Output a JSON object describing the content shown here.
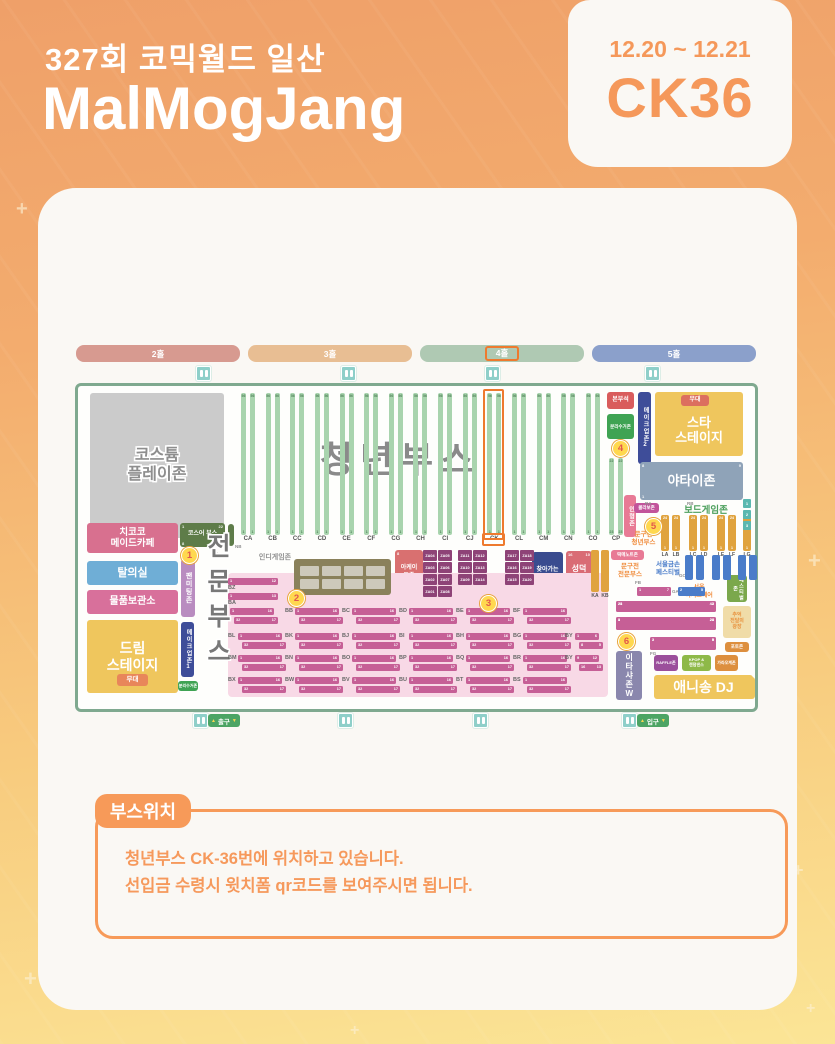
{
  "header": {
    "event": "327회 코믹월드 일산",
    "title": "MalMogJang",
    "date_range": "12.20 ~ 12.21",
    "booth_code": "CK36"
  },
  "location_note": {
    "badge": "부스위치",
    "line1": "청년부스 CK-36번에 위치하고 있습니다.",
    "line2": "선입금 수령시 윗치폼 qr코드를 보여주시면 됩니다."
  },
  "decor": {
    "plus_marks": [
      {
        "x": 16,
        "y": 198,
        "s": 20
      },
      {
        "x": 808,
        "y": 548,
        "s": 22
      },
      {
        "x": 793,
        "y": 860,
        "s": 18
      },
      {
        "x": 24,
        "y": 966,
        "s": 22
      },
      {
        "x": 350,
        "y": 1022,
        "s": 16
      },
      {
        "x": 806,
        "y": 1000,
        "s": 16
      }
    ]
  },
  "map": {
    "halls": [
      {
        "label": "2홀",
        "x": 1,
        "w": 164,
        "color": "#D79A90",
        "highlighted": false
      },
      {
        "label": "3홀",
        "x": 173,
        "w": 164,
        "color": "#E8BE93",
        "highlighted": false
      },
      {
        "label": "4홀",
        "x": 345,
        "w": 164,
        "color": "#AFC9B3",
        "highlighted": true
      },
      {
        "label": "5홀",
        "x": 517,
        "w": 164,
        "color": "#8BA0CB",
        "highlighted": false
      }
    ],
    "restrooms": {
      "top": [
        121,
        266,
        410,
        570
      ],
      "bottom": [
        118,
        263,
        398,
        547
      ]
    },
    "signs": [
      {
        "name": "exit-sign",
        "label": "출구",
        "x": 133
      },
      {
        "name": "entry-sign",
        "label": "입구",
        "x": 562
      }
    ],
    "youth": {
      "big_label": "청년부스",
      "columns": [
        "CA",
        "CB",
        "CC",
        "CD",
        "CE",
        "CF",
        "CG",
        "CH",
        "CI",
        "CJ",
        "CK",
        "CL",
        "CM",
        "CN",
        "CO"
      ],
      "highlight": "CK",
      "first_x": 166,
      "dx": 24.64,
      "y": 48,
      "h": 142,
      "label_y": 191,
      "top_num": "56",
      "bottom_num": "1",
      "cp": {
        "label": "CP",
        "x": 534,
        "y": 113,
        "h": 77,
        "nums": [
          "22",
          "23"
        ]
      }
    },
    "zones": [
      {
        "n": "costume-playzone",
        "x": 15,
        "y": 48,
        "w": 134,
        "h": 145,
        "bg": "#CBCBCB",
        "fg": "#8E8E8E",
        "fs": 16,
        "fw": 800,
        "out": true,
        "lines": [
          "코스튬",
          "플레이존"
        ]
      },
      {
        "n": "chikoko-maid-cafe",
        "x": 12,
        "y": 178,
        "w": 91,
        "h": 30,
        "bg": "#D8708F",
        "fs": 9.5,
        "lines": [
          "치코코",
          "메이드카페"
        ]
      },
      {
        "n": "cosplayer-booth",
        "x": 105,
        "y": 178,
        "w": 45,
        "h": 24,
        "bg": "#5E7C49",
        "fs": 6,
        "lines": [
          "코스어 부스"
        ],
        "corners": [
          "1",
          "22",
          "8",
          "28"
        ]
      },
      {
        "n": "cosplayer-side-column",
        "x": 153,
        "y": 179,
        "w": 6,
        "h": 22,
        "bg": "#5E7C49",
        "fs": 4,
        "lines": []
      },
      {
        "n": "fitting-room",
        "x": 12,
        "y": 216,
        "w": 91,
        "h": 24,
        "bg": "#6FAED6",
        "fs": 11,
        "lines": [
          "탈의실"
        ]
      },
      {
        "n": "fan-meeting-zone",
        "x": 106,
        "y": 214,
        "w": 14,
        "h": 58,
        "bg": "#B98CC0",
        "fs": 7,
        "v": true,
        "lines": [
          "팬미팅존"
        ]
      },
      {
        "n": "storage",
        "x": 12,
        "y": 245,
        "w": 91,
        "h": 24,
        "bg": "#D8709B",
        "fs": 10,
        "lines": [
          "물품보관소"
        ]
      },
      {
        "n": "dream-stage",
        "x": 12,
        "y": 275,
        "w": 91,
        "h": 73,
        "bg": "#EFC65D",
        "fs": 14,
        "fw": 800,
        "lines": [
          "드림",
          "스테이지"
        ]
      },
      {
        "n": "dream-stage-stand",
        "x": 42,
        "y": 329,
        "w": 31,
        "h": 12,
        "bg": "#E8865A",
        "fs": 6.5,
        "lines": [
          "무대"
        ]
      },
      {
        "n": "makeup-zone-1",
        "x": 106,
        "y": 277,
        "w": 13,
        "h": 55,
        "bg": "#3E4D99",
        "fs": 6,
        "v": true,
        "lines": [
          "메이크업존1"
        ]
      },
      {
        "n": "recycle-zone-left",
        "x": 103,
        "y": 336,
        "w": 20,
        "h": 10,
        "bg": "#3FA353",
        "fs": 4,
        "lines": [
          "분리수거존"
        ]
      },
      {
        "n": "hq-seat",
        "x": 532,
        "y": 47,
        "w": 27,
        "h": 17,
        "bg": "#D95C5C",
        "fs": 6,
        "lines": [
          "본부석"
        ]
      },
      {
        "n": "recycle-zone-top",
        "x": 532,
        "y": 69,
        "w": 27,
        "h": 25,
        "bg": "#3FA353",
        "fs": 4.5,
        "lines": [
          "분리수거존"
        ]
      },
      {
        "n": "makeup-zone-2",
        "x": 563,
        "y": 47,
        "w": 13,
        "h": 72,
        "bg": "#3E4D99",
        "fs": 6,
        "v": true,
        "lines": [
          "메이크업존2"
        ]
      },
      {
        "n": "star-stage",
        "x": 580,
        "y": 47,
        "w": 88,
        "h": 64,
        "bg": "#EFC65D",
        "fs": 13,
        "fw": 800,
        "pt": 12,
        "lines": [
          "스타",
          "스테이지"
        ]
      },
      {
        "n": "star-stage-stand",
        "x": 606,
        "y": 50,
        "w": 28,
        "h": 11,
        "bg": "#DC6F5F",
        "fs": 6,
        "lines": [
          "무대"
        ]
      },
      {
        "n": "yatai-zone",
        "x": 565,
        "y": 117,
        "w": 103,
        "h": 38,
        "bg": "#8FA3B8",
        "fs": 13,
        "fw": 800,
        "lines": [
          "야타이존"
        ],
        "corners": [
          "8",
          "9",
          "1",
          ""
        ]
      },
      {
        "n": "doll-zone",
        "x": 549,
        "y": 150,
        "w": 12,
        "h": 42,
        "bg": "#E87A95",
        "fs": 6,
        "v": true,
        "lines": [
          "인형존"
        ]
      },
      {
        "n": "collab-zone",
        "x": 559,
        "y": 158,
        "w": 25,
        "h": 10,
        "bg": "#C2549B",
        "fs": 4.5,
        "lines": [
          "콜라보존"
        ]
      },
      {
        "n": "ddeokme-note-zone",
        "x": 536,
        "y": 205,
        "w": 33,
        "h": 10,
        "bg": "#E87A95",
        "fs": 4.5,
        "lines": [
          "떡메노트존"
        ]
      },
      {
        "n": "arcade-zone",
        "x": 320,
        "y": 205,
        "w": 28,
        "h": 45,
        "bg": "#D97070",
        "fs": 6,
        "lines": [
          "아케이",
          "드존"
        ],
        "corners": [
          "8",
          "",
          "1",
          "2"
        ]
      },
      {
        "n": "pd-booth",
        "x": 457,
        "y": 207,
        "w": 31,
        "h": 45,
        "bg": "#3A4C8F",
        "fs": 6,
        "lines": [
          "찾아가는",
          "PD님"
        ]
      },
      {
        "n": "seongdeok-booth",
        "x": 491,
        "y": 206,
        "w": 26,
        "h": 45,
        "bg": "#D96C75",
        "fs": 8,
        "lines": [
          "성덕",
          "부스"
        ],
        "corners": [
          "16",
          "10",
          "1",
          "8"
        ]
      },
      {
        "n": "festival-zone",
        "x": 652,
        "y": 230,
        "w": 20,
        "h": 27,
        "bg": "#7BA84C",
        "fs": 5,
        "v": true,
        "lines": [
          "페스티벌존"
        ]
      },
      {
        "n": "plaza",
        "x": 648,
        "y": 261,
        "w": 28,
        "h": 32,
        "bg": "#F0DCA8",
        "fg": "#E8923E",
        "fs": 5,
        "lines": [
          "추억",
          "전달의",
          "광장"
        ]
      },
      {
        "n": "photo-zone",
        "x": 650,
        "y": 297,
        "w": 24,
        "h": 10,
        "bg": "#DD8F3E",
        "fs": 4.5,
        "lines": [
          "포토존"
        ]
      },
      {
        "n": "itasha-zone",
        "x": 541,
        "y": 306,
        "w": 26,
        "h": 49,
        "bg": "#8A87AD",
        "fs": 8,
        "v": true,
        "lines": [
          "이타샤존W"
        ]
      },
      {
        "n": "raffle-zone",
        "x": 579,
        "y": 310,
        "w": 24,
        "h": 16,
        "bg": "#9B4F9B",
        "fs": 4,
        "lines": [
          "RAFFLE존"
        ]
      },
      {
        "n": "kpop-zone",
        "x": 607,
        "y": 310,
        "w": 29,
        "h": 16,
        "bg": "#8EB948",
        "fs": 4,
        "lines": [
          "KPOP &",
          "랜덤댄스"
        ]
      },
      {
        "n": "karaoke-zone",
        "x": 640,
        "y": 310,
        "w": 23,
        "h": 16,
        "bg": "#DD8F3E",
        "fs": 4,
        "lines": [
          "가라오케존"
        ]
      },
      {
        "n": "anisong-dj",
        "x": 579,
        "y": 330,
        "w": 99,
        "h": 24,
        "bg": "#EFC65D",
        "fs": 14,
        "fw": 800,
        "lines": [
          "애니송 DJ"
        ]
      },
      {
        "n": "corner-booth",
        "x": 666,
        "y": 332,
        "w": 14,
        "h": 22,
        "bg": "#EFC65D",
        "fs": 4,
        "lines": []
      }
    ],
    "texts": [
      {
        "n": "indie-game-label",
        "x": 180,
        "y": 209,
        "w": 40,
        "fs": 7,
        "fg": "#8F8F8F",
        "lines": [
          "인디게임존"
        ]
      },
      {
        "n": "boardgame-label",
        "x": 595,
        "y": 160,
        "w": 72,
        "fs": 9.5,
        "fg": "#4DA05D",
        "lines": [
          "보드게임존"
        ]
      },
      {
        "n": "stationery-youth-label",
        "x": 550,
        "y": 186,
        "w": 37,
        "fs": 6.5,
        "fg": "#F08C3C",
        "lines": [
          "문구전",
          "청년부스"
        ]
      },
      {
        "n": "stationery-pro-label",
        "x": 536,
        "y": 218,
        "w": 38,
        "fs": 6.5,
        "fg": "#F08C3C",
        "lines": [
          "문구전",
          "전문부스"
        ]
      },
      {
        "n": "gold-hands-festival-label",
        "x": 574,
        "y": 216,
        "w": 38,
        "fs": 6.5,
        "fg": "#4A7CC9",
        "lines": [
          "서울금손",
          "페스티벌"
        ]
      },
      {
        "n": "dessert-fair-label",
        "x": 600,
        "y": 240,
        "w": 48,
        "fs": 6,
        "fg": "#F08C3C",
        "lines": [
          "서울",
          "디저트페어"
        ]
      }
    ],
    "tiny_labels": [
      {
        "t": "RA",
        "x": 570,
        "y": 156
      },
      {
        "t": "RB",
        "x": 612,
        "y": 156
      },
      {
        "t": "NA",
        "x": 136,
        "y": 204
      },
      {
        "t": "NB",
        "x": 160,
        "y": 199
      },
      {
        "t": "FB",
        "x": 560,
        "y": 235
      },
      {
        "t": "GA",
        "x": 597,
        "y": 244
      },
      {
        "t": "GC",
        "x": 604,
        "y": 228
      },
      {
        "t": "FG",
        "x": 575,
        "y": 306
      }
    ],
    "pro_area": {
      "title": "전문부스",
      "bg": {
        "x": 153,
        "y": 228,
        "w": 380,
        "h": 124
      },
      "singles": [
        {
          "label": "BZ",
          "y": 233,
          "nums": [
            "1",
            "12"
          ]
        },
        {
          "label": "BA",
          "y": 248,
          "nums": [
            "1",
            "13"
          ]
        }
      ],
      "rows": [
        {
          "y": 263,
          "cells": [
            "",
            "BB",
            "BC",
            "BD",
            "BE",
            "BF"
          ]
        },
        {
          "y": 288,
          "cells": [
            "BL",
            "BK",
            "BJ",
            "BI",
            "BH",
            "BG"
          ]
        },
        {
          "y": 310,
          "cells": [
            "BM",
            "BN",
            "BO",
            "BP",
            "BQ",
            "BR"
          ]
        },
        {
          "y": 332,
          "cells": [
            "BX",
            "BW",
            "BV",
            "BU",
            "BT",
            "BS"
          ]
        }
      ],
      "cell_x0": 153,
      "cell_dx": 57,
      "bar_nums": [
        "1",
        "16",
        "32",
        "17"
      ],
      "by_cells": [
        {
          "label": "BY",
          "x": 490,
          "y": 288,
          "bars": [
            [
              "1",
              "6"
            ],
            [
              "8",
              "5"
            ]
          ]
        },
        {
          "label": "BY",
          "x": 490,
          "y": 310,
          "bars": [
            [
              "9",
              "12"
            ],
            [
              "16",
              "13"
            ]
          ]
        }
      ]
    },
    "indie_box": {
      "x": 219,
      "y": 214,
      "w": 97,
      "h": 36,
      "tables": 8
    },
    "za": {
      "y0": 205,
      "rh": 12,
      "blocks": [
        {
          "x": 348,
          "rows": [
            [
              "ZA04",
              "ZA05"
            ],
            [
              "ZA03",
              "ZA06"
            ],
            [
              "ZA02",
              "ZA07"
            ],
            [
              "ZA01",
              "ZA08"
            ]
          ]
        },
        {
          "x": 383,
          "rows": [
            [
              "ZA11",
              "ZA12"
            ],
            [
              "ZA10",
              "ZA13"
            ],
            [
              "ZA09",
              "ZA14"
            ]
          ]
        },
        {
          "x": 430,
          "rows": [
            [
              "ZA17",
              "ZA18"
            ],
            [
              "ZA16",
              "ZA19"
            ],
            [
              "ZA15",
              "ZA20"
            ]
          ]
        }
      ]
    },
    "l_columns": {
      "labels": [
        "LA",
        "LB",
        "LC",
        "LD",
        "LE",
        "LF",
        "LG"
      ],
      "xs": [
        586,
        597,
        614,
        625,
        642,
        653,
        668
      ],
      "y": 170,
      "h": 36,
      "color": "#E0A33E",
      "top_num": "24",
      "bottom_num": "1"
    },
    "k_columns": {
      "labels": [
        "KA",
        "KB"
      ],
      "xs": [
        516,
        526
      ],
      "y": 205,
      "h": 42,
      "color": "#E0A33E"
    },
    "blue_columns": {
      "xs": [
        610,
        621,
        637,
        648,
        663,
        674
      ],
      "y": 210,
      "h": 25,
      "color": "#4A7CC9"
    },
    "boardgame_minis": [
      {
        "x": 668,
        "y": 154,
        "t": "1"
      },
      {
        "x": 668,
        "y": 165,
        "t": "2"
      },
      {
        "x": 668,
        "y": 176,
        "t": "3"
      }
    ],
    "dessert_bars": [
      {
        "x": 541,
        "y": 256,
        "w": 100,
        "h": 11,
        "nums": [
          "24",
          "42",
          "25",
          "43"
        ],
        "blue": false
      },
      {
        "x": 541,
        "y": 272,
        "w": 100,
        "h": 13,
        "nums": [
          "8",
          "24",
          "1",
          "23"
        ],
        "blue": false
      },
      {
        "x": 575,
        "y": 292,
        "w": 66,
        "h": 13,
        "nums": [
          "2",
          "8",
          "1",
          "5"
        ],
        "blue": false
      },
      {
        "x": 562,
        "y": 242,
        "w": 34,
        "h": 9,
        "nums": [
          "1",
          "7",
          "",
          ""
        ],
        "blue": false
      },
      {
        "x": 603,
        "y": 242,
        "w": 27,
        "h": 9,
        "nums": [
          "2",
          "5",
          "",
          ""
        ],
        "blue": true
      }
    ],
    "markers": [
      {
        "n": "1",
        "x": 106,
        "y": 202
      },
      {
        "n": "2",
        "x": 213,
        "y": 245
      },
      {
        "n": "3",
        "x": 405,
        "y": 250
      },
      {
        "n": "4",
        "x": 537,
        "y": 95
      },
      {
        "n": "5",
        "x": 570,
        "y": 173
      },
      {
        "n": "6",
        "x": 543,
        "y": 288
      }
    ]
  }
}
